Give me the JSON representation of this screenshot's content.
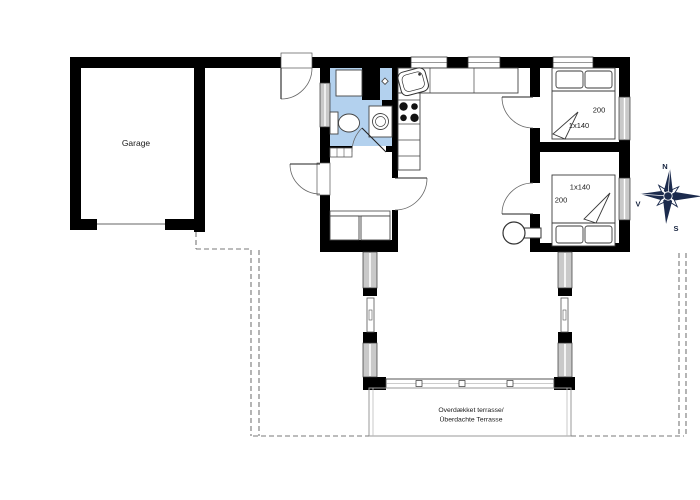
{
  "labels": {
    "garage": "Garage",
    "bedroom1": {
      "length": "200",
      "width": "1x140"
    },
    "bedroom2": {
      "length": "200",
      "width": "1x140"
    },
    "terrace_line1": "Overdækket terrasse/",
    "terrace_line2": "Überdachte Terrasse",
    "compass": {
      "north": "N",
      "west": "V",
      "south": "S"
    }
  },
  "colors": {
    "wall": "#000000",
    "bathroom_fill": "#b3d1ee",
    "window_fill": "#c9c9c9",
    "compass": "#1c2b4d",
    "dashed": "#787878"
  }
}
